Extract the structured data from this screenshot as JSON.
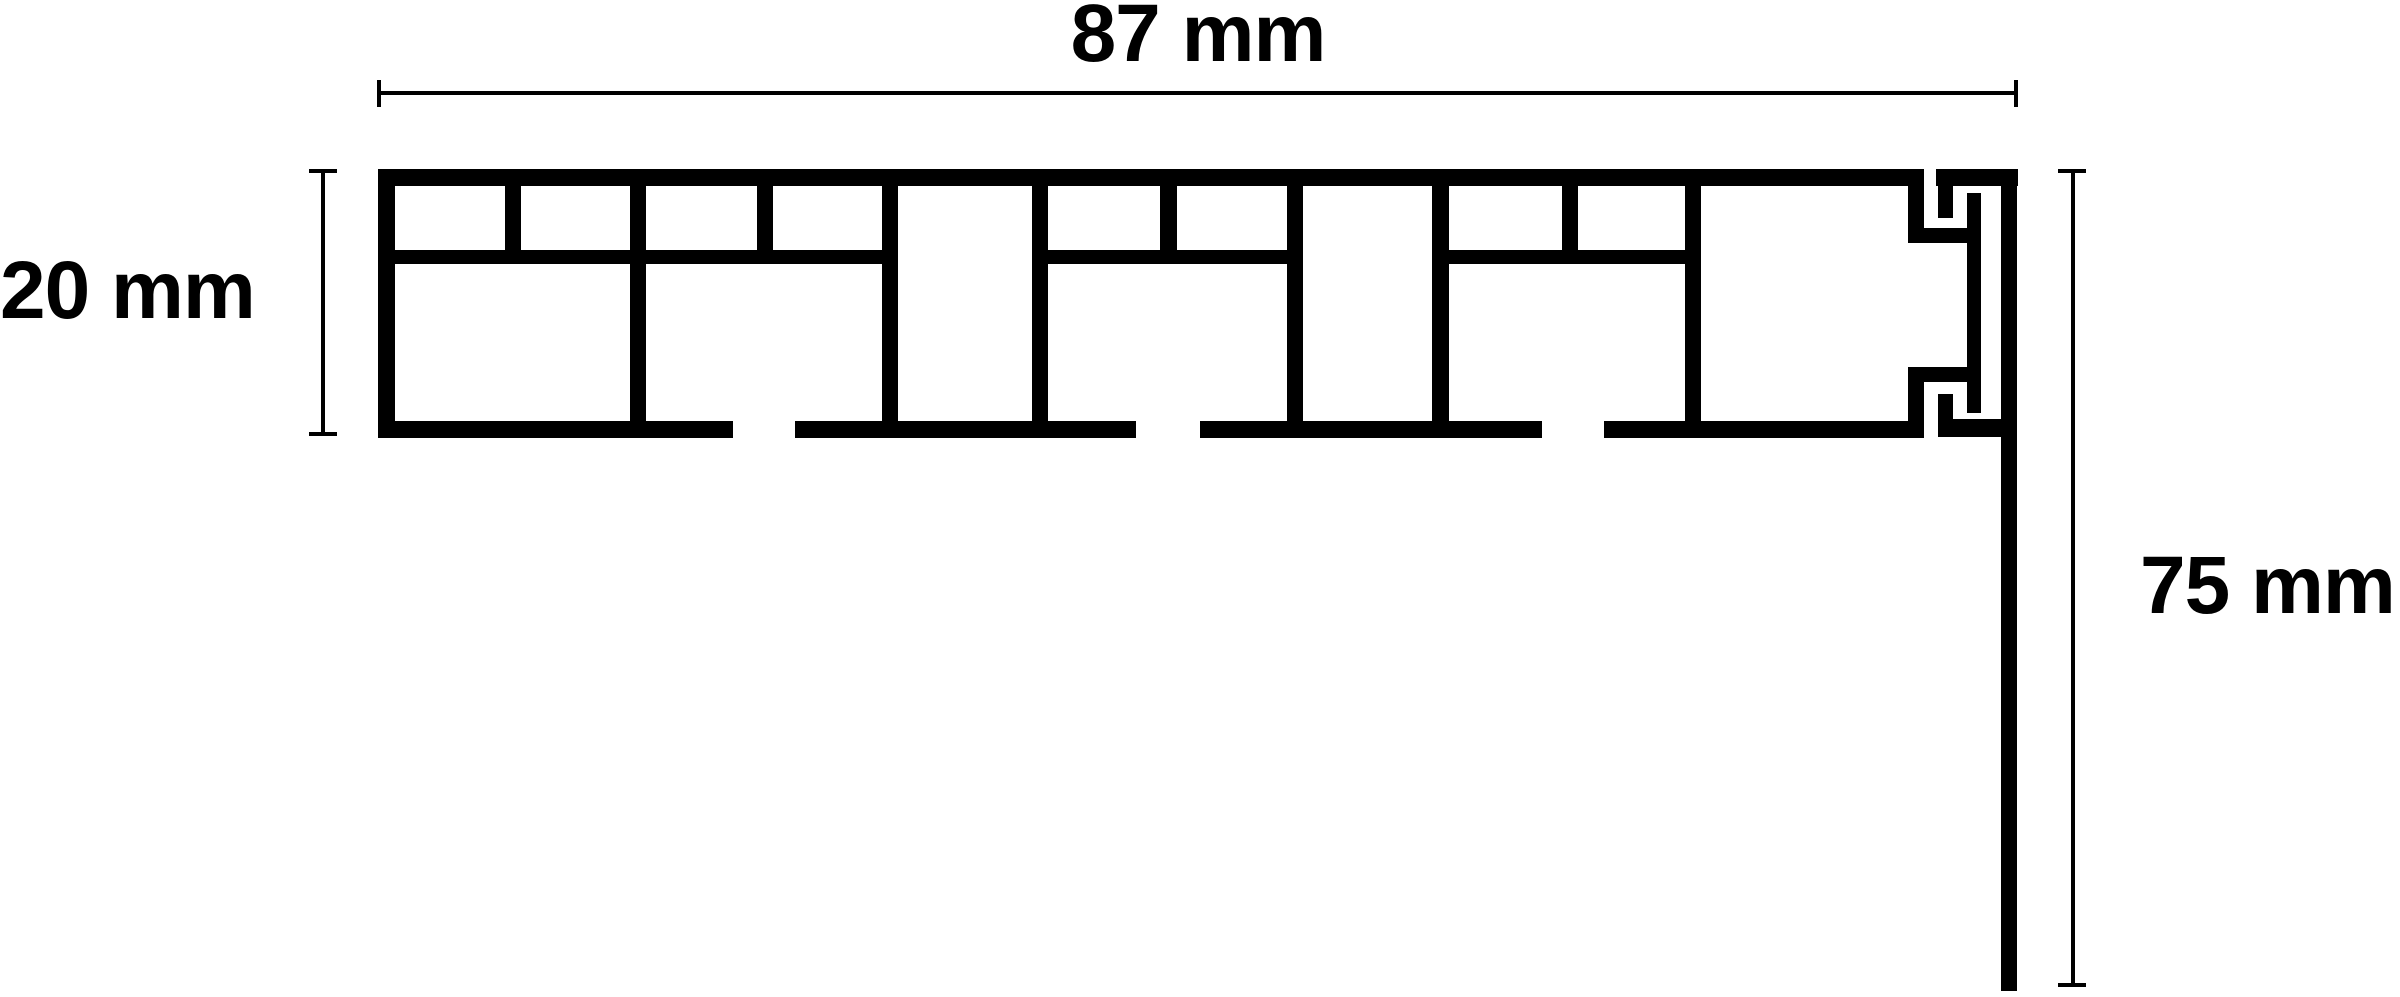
{
  "canvas": {
    "width": 2400,
    "height": 997,
    "background_color": "#ffffff",
    "line_color": "#000000"
  },
  "diagram": {
    "kind": "technical-cross-section",
    "subject": "multi-chamber windowsill profile with snap-fit end groove and vertical leg"
  },
  "dimensions": {
    "width": {
      "label": "87 mm",
      "value": 87,
      "unit": "mm",
      "orientation": "horizontal",
      "measures": "profile overall width"
    },
    "height": {
      "label": "20 mm",
      "value": 20,
      "unit": "mm",
      "orientation": "vertical",
      "measures": "profile overall thickness"
    },
    "drop": {
      "label": "75 mm",
      "value": 75,
      "unit": "mm",
      "orientation": "vertical",
      "measures": "end leg overall drop"
    }
  },
  "profile": {
    "rects": [
      [
        378,
        169,
        1546,
        17
      ],
      [
        1936,
        169,
        82,
        17
      ],
      [
        378,
        169,
        17,
        269
      ],
      [
        378,
        421,
        355,
        17
      ],
      [
        795,
        421,
        341,
        17
      ],
      [
        1200,
        421,
        342,
        17
      ],
      [
        1604,
        421,
        320,
        17
      ],
      [
        390,
        250,
        494,
        14
      ],
      [
        1040,
        250,
        250,
        14
      ],
      [
        1445,
        250,
        250,
        14
      ],
      [
        505,
        180,
        16,
        84
      ],
      [
        757,
        180,
        16,
        84
      ],
      [
        1160,
        180,
        17,
        84
      ],
      [
        1562,
        180,
        16,
        84
      ],
      [
        630,
        176,
        16,
        260
      ],
      [
        882,
        176,
        16,
        260
      ],
      [
        1032,
        176,
        16,
        260
      ],
      [
        1287,
        176,
        16,
        260
      ],
      [
        1432,
        176,
        17,
        260
      ],
      [
        1685,
        176,
        16,
        260
      ],
      [
        1908,
        176,
        16,
        67
      ],
      [
        1908,
        228,
        64,
        15
      ],
      [
        1938,
        183,
        15,
        35
      ],
      [
        1967,
        193,
        14,
        220
      ],
      [
        1908,
        367,
        16,
        70
      ],
      [
        1908,
        367,
        60,
        15
      ],
      [
        1938,
        394,
        15,
        43
      ],
      [
        1938,
        419,
        65,
        18
      ],
      [
        2001,
        169,
        16,
        822
      ]
    ]
  }
}
